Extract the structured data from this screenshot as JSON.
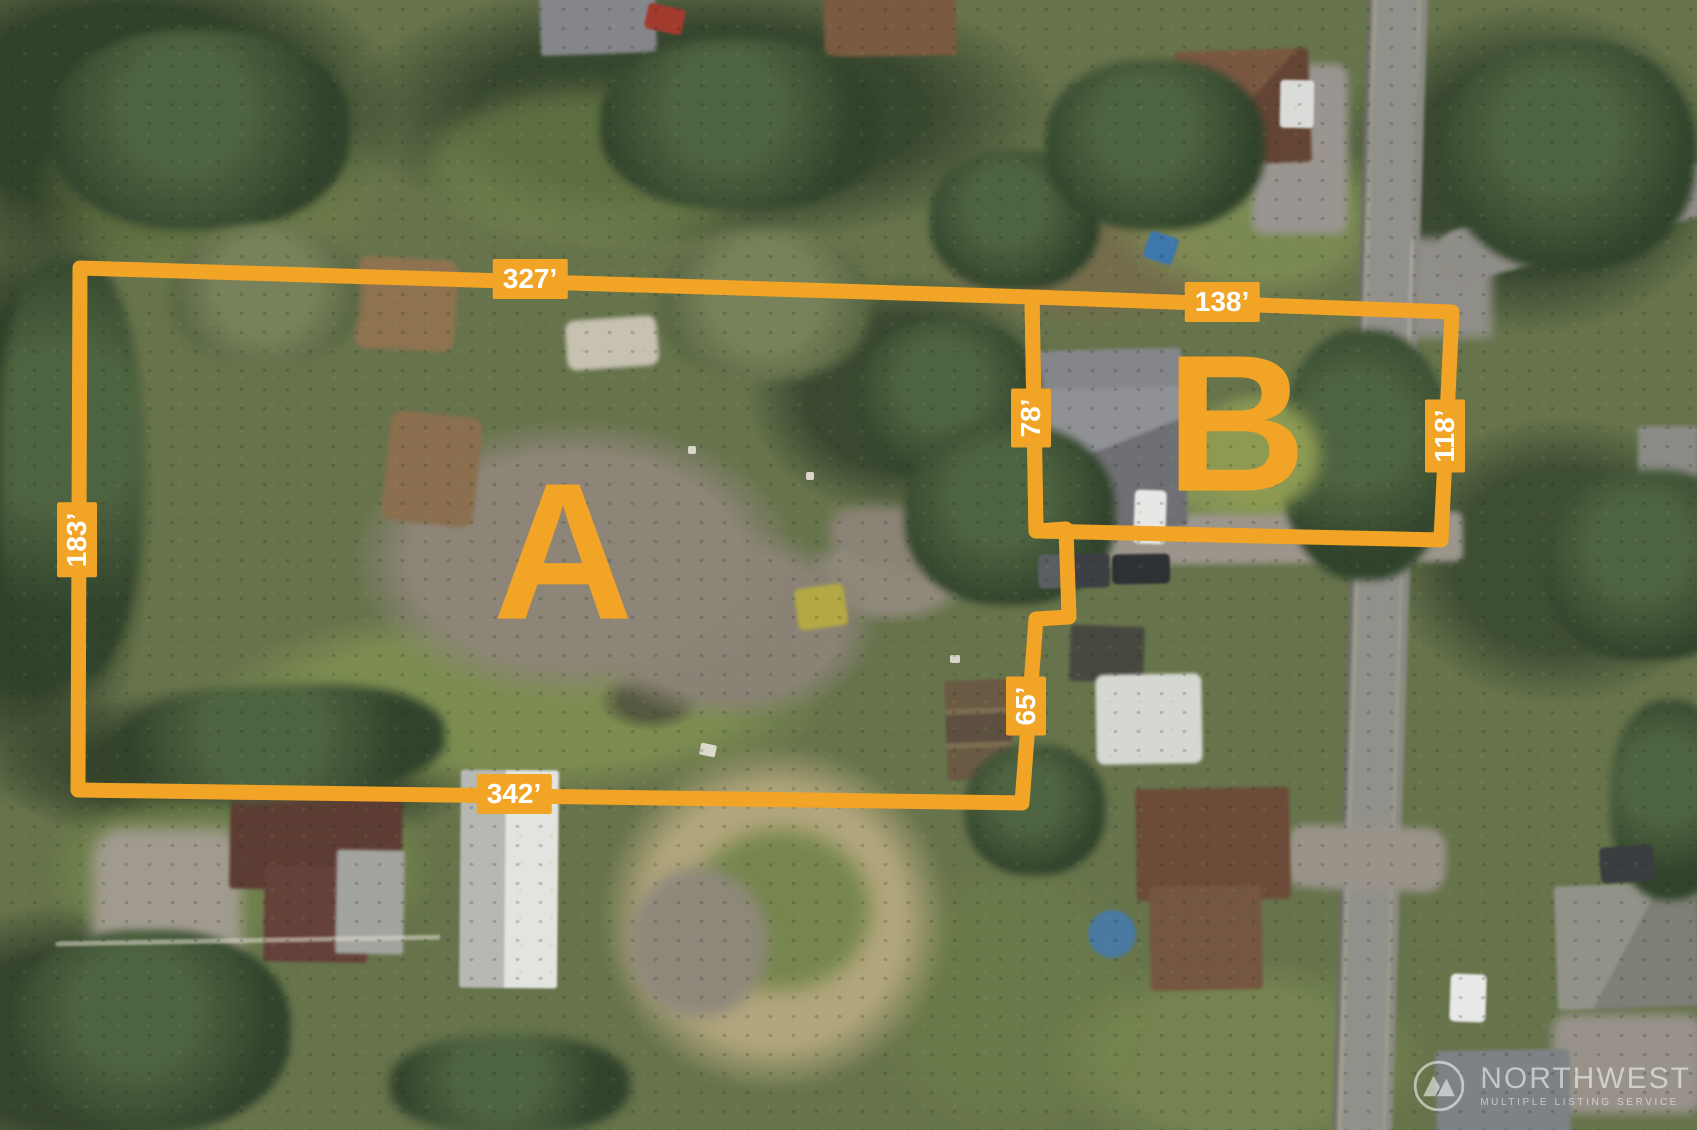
{
  "colors": {
    "accent_orange": "#F2A426",
    "label_text": "#FFFFFF",
    "watermark_text": "rgba(255,255,255,0.55)"
  },
  "overlay": {
    "stroke_width": 15
  },
  "parcels": [
    {
      "id": "A",
      "letter": "A",
      "outline": [
        [
          80,
          268
        ],
        [
          1032,
          297
        ],
        [
          1036,
          531
        ],
        [
          1066,
          529
        ],
        [
          1069,
          617
        ],
        [
          1036,
          619
        ],
        [
          1022,
          803
        ],
        [
          78,
          790
        ]
      ],
      "letter_pos": {
        "x": 563,
        "y": 556
      },
      "measurements": [
        {
          "text": "327’",
          "x": 530,
          "y": 279,
          "orientation": "horizontal",
          "edge": "north"
        },
        {
          "text": "183’",
          "x": 77,
          "y": 540,
          "orientation": "vertical",
          "edge": "west"
        },
        {
          "text": "78’",
          "x": 1031,
          "y": 418,
          "orientation": "vertical",
          "edge": "east-upper"
        },
        {
          "text": "65’",
          "x": 1026,
          "y": 706,
          "orientation": "vertical",
          "edge": "east-lower"
        },
        {
          "text": "342’",
          "x": 514,
          "y": 794,
          "orientation": "horizontal",
          "edge": "south"
        }
      ]
    },
    {
      "id": "B",
      "letter": "B",
      "outline": [
        [
          1032,
          297
        ],
        [
          1452,
          312
        ],
        [
          1441,
          540
        ],
        [
          1036,
          531
        ]
      ],
      "letter_pos": {
        "x": 1236,
        "y": 428
      },
      "measurements": [
        {
          "text": "138’",
          "x": 1222,
          "y": 302,
          "orientation": "horizontal",
          "edge": "north"
        },
        {
          "text": "118’",
          "x": 1445,
          "y": 436,
          "orientation": "vertical",
          "edge": "east"
        }
      ]
    }
  ],
  "watermark": {
    "line1": "NORTHWEST",
    "line2": "MULTIPLE LISTING SERVICE",
    "logo": "mountain-peaks-icon"
  }
}
